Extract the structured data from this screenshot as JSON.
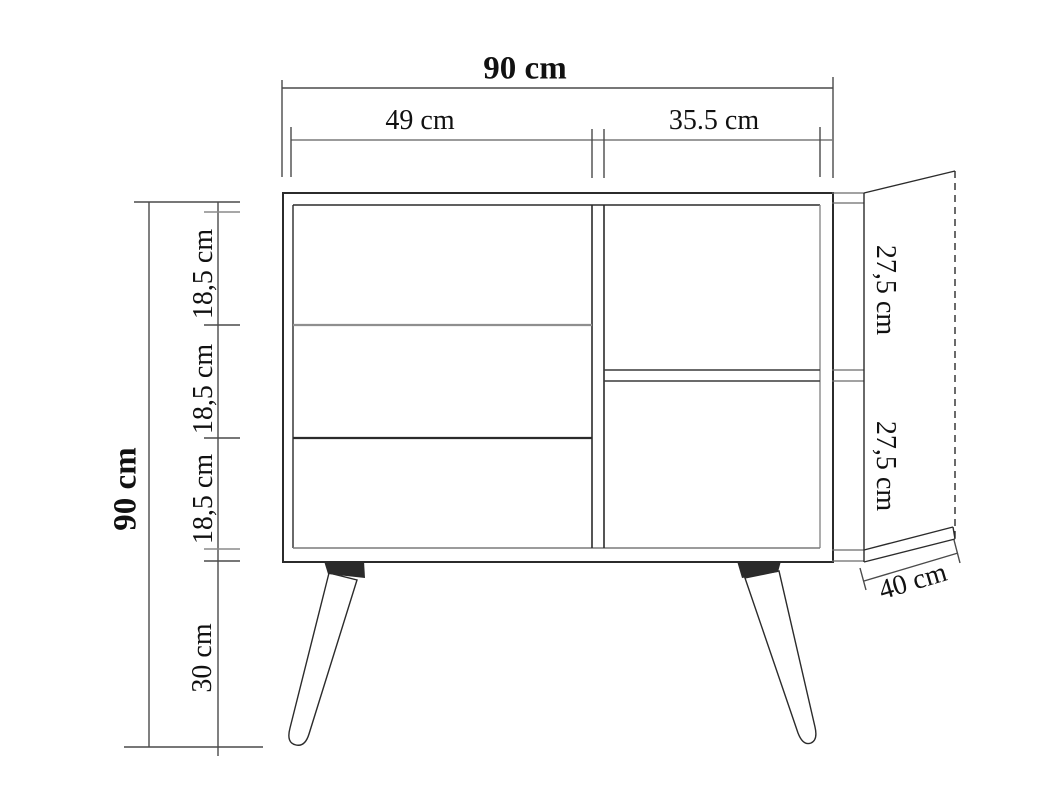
{
  "diagram": {
    "type": "furniture technical drawing (sideboard / dresser with exploded side panel)",
    "dims": {
      "width_total": "90 cm",
      "width_left": "49 cm",
      "width_right": "35.5 cm",
      "height_total": "90 cm",
      "drawers": [
        "18,5 cm",
        "18,5 cm",
        "18,5 cm"
      ],
      "legs": "30 cm",
      "side_upper": "27,5 cm",
      "side_lower": "27,5 cm",
      "depth": "40 cm"
    },
    "colors": {
      "line": "#2b2b2b",
      "line_light": "#8a8a8a",
      "bracket_fill": "#2b2b2b",
      "background": "#ffffff"
    }
  }
}
